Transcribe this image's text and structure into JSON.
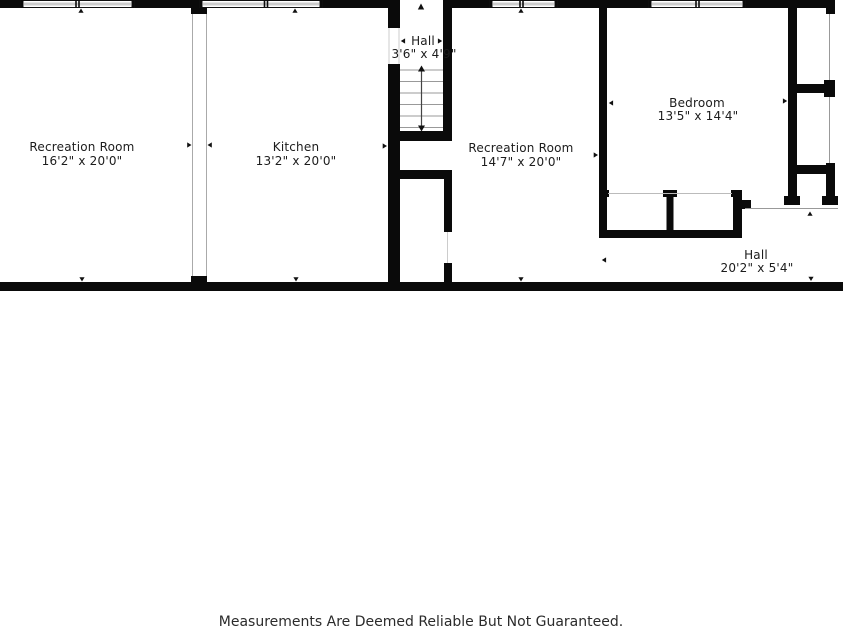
{
  "floorplan": {
    "title": "basement-floor-plan",
    "rooms": [
      {
        "name": "Recreation Room",
        "dimensions": "16'2\" x 20'0\""
      },
      {
        "name": "Kitchen",
        "dimensions": "13'2\" x 20'0\""
      },
      {
        "name": "Hall",
        "dimensions": "3'6\" x 4'9\""
      },
      {
        "name": "Recreation Room",
        "dimensions": "14'7\" x 20'0\""
      },
      {
        "name": "Bedroom",
        "dimensions": "13'5\" x 14'4\""
      },
      {
        "name": "Hall",
        "dimensions": "20'2\" x 5'4\""
      }
    ],
    "disclaimer": "Measurements Are Deemed Reliable But Not Guaranteed.",
    "colors": {
      "wall": "#0a0a0a",
      "thin_partition": "#aaaaaa",
      "stair_tread": "#999999",
      "text": "#1c1c1c"
    }
  }
}
